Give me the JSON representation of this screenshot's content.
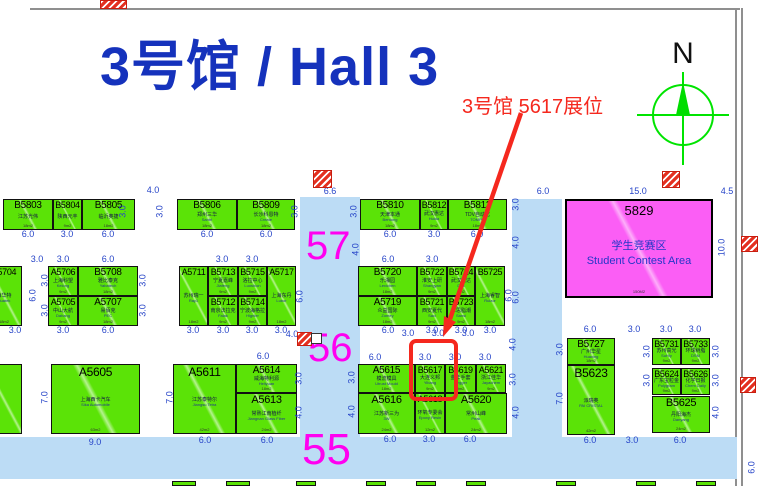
{
  "title": {
    "text": "3号馆 / Hall 3",
    "color": "#1532BC"
  },
  "annotation": {
    "text": "3号馆 5617展位",
    "color": "#F5281E",
    "target_booth": "B5617"
  },
  "compass": {
    "label": "N",
    "color": "#00E400"
  },
  "aisles": {
    "a57": {
      "label": "57"
    },
    "a56": {
      "label": "56"
    },
    "a55": {
      "label": "55"
    },
    "number_color": "#FF00F0"
  },
  "contest_area": {
    "number": "5829",
    "name_cn": "学生竞赛区",
    "name_en": "Student Contest Area",
    "size": "150M2",
    "fill": "#FB5EF5"
  },
  "colors": {
    "booth_green": "#5BE307",
    "aisle_blue": "#BCDCF5",
    "dim_blue": "#2644C8",
    "highlight_red": "#F5281E"
  },
  "booths": [
    {
      "n": "B5803",
      "cn": "江苏光伟",
      "en": "",
      "sz": "18m2",
      "r": [
        3,
        199,
        50,
        31
      ],
      "fs": 10
    },
    {
      "n": "B5804",
      "cn": "陕西元丰",
      "en": "",
      "sz": "9m2",
      "r": [
        53,
        199,
        29,
        31
      ],
      "fs": 9
    },
    {
      "n": "B5805",
      "cn": "临沂奥捷",
      "en": "",
      "sz": "18m2",
      "r": [
        82,
        199,
        53,
        31
      ],
      "fs": 10
    },
    {
      "n": "B5806",
      "cn": "郑州三华",
      "en": "Santri",
      "sz": "18m2",
      "r": [
        177,
        199,
        60,
        31
      ],
      "fs": 10
    },
    {
      "n": "B5809",
      "cn": "长沙科恩特",
      "en": "Create",
      "sz": "18m2",
      "r": [
        237,
        199,
        58,
        31
      ],
      "fs": 10
    },
    {
      "n": "B5810",
      "cn": "天津本通",
      "en": "Bentong",
      "sz": "18m2",
      "r": [
        360,
        199,
        60,
        31
      ],
      "fs": 10
    },
    {
      "n": "B5812",
      "cn": "武汉惠达",
      "en": "Huida",
      "sz": "9m2",
      "r": [
        420,
        199,
        28,
        31
      ],
      "fs": 9
    },
    {
      "n": "B5813",
      "cn": "TDV自动化",
      "en": "TOMPO",
      "sz": "18m2",
      "r": [
        448,
        199,
        59,
        31
      ],
      "fs": 10
    },
    {
      "n": "A5704",
      "cn": "西华特",
      "en": "Huatek",
      "sz": "18m2",
      "r": [
        -14,
        266,
        36,
        60
      ],
      "fs": 9
    },
    {
      "n": "A5706",
      "cn": "上海科望",
      "en": "Kelong",
      "sz": "9m2",
      "r": [
        48,
        266,
        30,
        30
      ],
      "fs": 9
    },
    {
      "n": "B5708",
      "cn": "雅比泰克",
      "en": "Yabatech",
      "sz": "18m2",
      "r": [
        78,
        266,
        60,
        30
      ],
      "fs": 10
    },
    {
      "n": "A5705",
      "cn": "中山大航",
      "en": "Dahang",
      "sz": "9m2",
      "r": [
        48,
        296,
        30,
        30
      ],
      "fs": 9
    },
    {
      "n": "A5707",
      "cn": "易佰克",
      "en": "PEC",
      "sz": "18m2",
      "r": [
        78,
        296,
        60,
        30
      ],
      "fs": 10
    },
    {
      "n": "A5711",
      "cn": "苏州瑞一",
      "en": "Ray1",
      "sz": "18m2",
      "r": [
        179,
        266,
        29,
        60
      ],
      "fs": 9
    },
    {
      "n": "B5713",
      "cn": "宁夏嘉峰",
      "en": "Jiafeng",
      "sz": "9m2",
      "r": [
        208,
        266,
        30,
        30
      ],
      "fs": 9
    },
    {
      "n": "B5715",
      "cn": "洛拉中心",
      "en": "Luoshion",
      "sz": "9m2",
      "r": [
        238,
        266,
        29,
        30
      ],
      "fs": 9
    },
    {
      "n": "A5717",
      "cn": "上海东丹",
      "en": "Lubor",
      "sz": "18m2",
      "r": [
        267,
        266,
        29,
        60
      ],
      "fs": 9
    },
    {
      "n": "B5712",
      "cn": "南京法拉克",
      "en": "Falak",
      "sz": "9m2",
      "r": [
        208,
        296,
        30,
        30
      ],
      "fs": 9
    },
    {
      "n": "B5714",
      "cn": "宁波海格拉",
      "en": "Hignler",
      "sz": "9m2",
      "r": [
        238,
        296,
        29,
        30
      ],
      "fs": 9
    },
    {
      "n": "B5720",
      "cn": "乐湘园",
      "en": "Lexichen",
      "sz": "18m2",
      "r": [
        358,
        266,
        59,
        30
      ],
      "fs": 10
    },
    {
      "n": "B5722",
      "cn": "淮安上研",
      "en": "Shangyan",
      "sz": "9m2",
      "r": [
        417,
        266,
        30,
        30
      ],
      "fs": 9
    },
    {
      "n": "B5724",
      "cn": "武汉君达",
      "en": "Dita",
      "sz": "9m2",
      "r": [
        447,
        266,
        28,
        30
      ],
      "fs": 9
    },
    {
      "n": "B5725",
      "cn": "上海睿智",
      "en": "Ruizor",
      "sz": "18m2",
      "r": [
        475,
        266,
        30,
        60
      ],
      "fs": 9
    },
    {
      "n": "A5719",
      "cn": "众益国际",
      "en": "Zomey",
      "sz": "18m2",
      "r": [
        358,
        296,
        59,
        30
      ],
      "fs": 10
    },
    {
      "n": "B5721",
      "cn": "西安夏代",
      "en": "Saci",
      "sz": "9m2",
      "r": [
        417,
        296,
        30,
        30
      ],
      "fs": 9
    },
    {
      "n": "B5723",
      "cn": "三思脂潮",
      "en": "Sansi",
      "sz": "9m2",
      "r": [
        447,
        296,
        28,
        30
      ],
      "fs": 9
    },
    {
      "n": "",
      "cn": "",
      "en": "",
      "sz": "",
      "r": [
        -14,
        364,
        36,
        70
      ],
      "fs": 9
    },
    {
      "n": "A5605",
      "cn": "上海西卡汽车",
      "en": "Sika Automobile",
      "sz": "63m2",
      "r": [
        51,
        364,
        89,
        70
      ],
      "fs": 12
    },
    {
      "n": "A5611",
      "cn": "江苏泰特尔",
      "en": "Jiangsu Tetra",
      "sz": "42m2",
      "r": [
        173,
        364,
        63,
        70
      ],
      "fs": 12
    },
    {
      "n": "A5614",
      "cn": "威海特利源",
      "en": "Heliyuan",
      "sz": "18m2",
      "r": [
        236,
        364,
        61,
        29
      ],
      "fs": 10
    },
    {
      "n": "A5613",
      "cn": "常熟江南植纤",
      "en": "Jiangnan Glass Fiber",
      "sz": "24m2",
      "r": [
        236,
        393,
        61,
        41
      ],
      "fs": 11
    },
    {
      "n": "A5615",
      "cn": "模流模具",
      "en": "Utrust Mould",
      "sz": "18m2",
      "r": [
        358,
        364,
        57,
        29
      ],
      "fs": 10
    },
    {
      "n": "B5617",
      "cn": "大连义邦",
      "en": "Yibang",
      "sz": "9m2",
      "r": [
        415,
        364,
        30,
        29
      ],
      "fs": 9
    },
    {
      "n": "B5619",
      "cn": "金华手套",
      "en": "Hegger",
      "sz": "9m2",
      "r": [
        445,
        364,
        31,
        29
      ],
      "fs": 9
    },
    {
      "n": "A5621",
      "cn": "浙江佳华",
      "en": "Jayachem",
      "sz": "9m2",
      "r": [
        476,
        364,
        30,
        29
      ],
      "fs": 9
    },
    {
      "n": "A5616",
      "cn": "江苏新三为",
      "en": "3W",
      "sz": "24m2",
      "r": [
        358,
        393,
        57,
        41
      ],
      "fs": 11
    },
    {
      "n": "A5618",
      "cn": "环氧专委会",
      "en": "Epoxy Resin",
      "sz": "12m2",
      "r": [
        415,
        393,
        30,
        41
      ],
      "fs": 9
    },
    {
      "n": "A5620",
      "cn": "常州山峰",
      "en": "Peak",
      "sz": "24m2",
      "r": [
        445,
        393,
        62,
        41
      ],
      "fs": 11
    },
    {
      "n": "B5727",
      "cn": "广州华星",
      "en": "Huaxing",
      "sz": "18m2",
      "r": [
        567,
        338,
        48,
        27
      ],
      "fs": 10
    },
    {
      "n": "B5623",
      "cn": "派瑞奥",
      "en": "PAI CRISTAL",
      "sz": "42m2",
      "r": [
        567,
        365,
        48,
        70
      ],
      "fs": 12
    },
    {
      "n": "B5731",
      "cn": "苏州高光",
      "en": "SuHiy",
      "sz": "9m2",
      "r": [
        652,
        338,
        29,
        27
      ],
      "fs": 9
    },
    {
      "n": "B5733",
      "cn": "环球树脂",
      "en": "DSM",
      "sz": "9m2",
      "r": [
        681,
        338,
        29,
        27
      ],
      "fs": 9
    },
    {
      "n": "B5624",
      "cn": "广东宝粒金",
      "en": "Polygram",
      "sz": "9m2",
      "r": [
        652,
        368,
        29,
        27
      ],
      "fs": 9
    },
    {
      "n": "B5626",
      "cn": "化学日报",
      "en": "Chem Daily",
      "sz": "9m2",
      "r": [
        681,
        368,
        29,
        27
      ],
      "fs": 9
    },
    {
      "n": "B5625",
      "cn": "丹阳海杰",
      "en": "Danyang",
      "sz": "24m2",
      "r": [
        652,
        396,
        58,
        37
      ],
      "fs": 11
    }
  ],
  "dimensions": [
    [
      "6.0",
      28,
      235,
      0
    ],
    [
      "3.0",
      67,
      235,
      0
    ],
    [
      "6.0",
      108,
      235,
      0
    ],
    [
      "4.0",
      153,
      191,
      0
    ],
    [
      "6.0",
      207,
      235,
      0
    ],
    [
      "6.0",
      266,
      235,
      0
    ],
    [
      "6.6",
      330,
      192,
      0
    ],
    [
      "6.0",
      390,
      235,
      0
    ],
    [
      "3.0",
      434,
      235,
      0
    ],
    [
      "6.0",
      477,
      235,
      0
    ],
    [
      "6.0",
      543,
      192,
      0
    ],
    [
      "15.0",
      638,
      192,
      0
    ],
    [
      "4.5",
      727,
      192,
      0
    ],
    [
      "10.0",
      722,
      248,
      1
    ],
    [
      "3.0",
      123,
      212,
      1
    ],
    [
      "3.0",
      160,
      212,
      1
    ],
    [
      "3.0",
      295,
      212,
      1
    ],
    [
      "3.0",
      354,
      212,
      1
    ],
    [
      "4.0",
      356,
      250,
      1
    ],
    [
      "3.0",
      516,
      205,
      1
    ],
    [
      "4.0",
      516,
      243,
      1
    ],
    [
      "6.0",
      516,
      298,
      1
    ],
    [
      "3.0",
      37,
      260,
      0
    ],
    [
      "3.0",
      63,
      260,
      0
    ],
    [
      "6.0",
      108,
      260,
      0
    ],
    [
      "3.0",
      222,
      260,
      0
    ],
    [
      "3.0",
      252,
      260,
      0
    ],
    [
      "6.0",
      388,
      260,
      0
    ],
    [
      "3.0",
      432,
      260,
      0
    ],
    [
      "3.0",
      15,
      331,
      0
    ],
    [
      "3.0",
      63,
      331,
      0
    ],
    [
      "6.0",
      108,
      331,
      0
    ],
    [
      "3.0",
      193,
      331,
      0
    ],
    [
      "3.0",
      223,
      331,
      0
    ],
    [
      "3.0",
      252,
      331,
      0
    ],
    [
      "3.0",
      281,
      331,
      0
    ],
    [
      "4.0",
      292,
      335,
      0
    ],
    [
      "6.0",
      388,
      331,
      0
    ],
    [
      "3.0",
      432,
      331,
      0
    ],
    [
      "3.0",
      461,
      331,
      0
    ],
    [
      "3.0",
      490,
      331,
      0
    ],
    [
      "6.0",
      33,
      296,
      1
    ],
    [
      "3.0",
      45,
      281,
      1
    ],
    [
      "3.0",
      45,
      311,
      1
    ],
    [
      "3.0",
      143,
      281,
      1
    ],
    [
      "3.0",
      143,
      311,
      1
    ],
    [
      "6.0",
      300,
      297,
      1
    ],
    [
      "6.0",
      509,
      296,
      1
    ],
    [
      "6.0",
      263,
      357,
      0
    ],
    [
      "6.0",
      375,
      358,
      0
    ],
    [
      "3.0",
      425,
      358,
      0
    ],
    [
      "3.0",
      455,
      358,
      0
    ],
    [
      "3.0",
      485,
      358,
      0
    ],
    [
      "3.0",
      408,
      334,
      0
    ],
    [
      "3.0",
      438,
      334,
      0
    ],
    [
      "3.0",
      468,
      334,
      0
    ],
    [
      "4.0",
      513,
      345,
      1
    ],
    [
      "3.0",
      513,
      380,
      1
    ],
    [
      "7.0",
      45,
      398,
      1
    ],
    [
      "7.0",
      170,
      398,
      1
    ],
    [
      "3.0",
      299,
      379,
      1
    ],
    [
      "4.0",
      299,
      413,
      1
    ],
    [
      "3.0",
      352,
      378,
      1
    ],
    [
      "4.0",
      352,
      412,
      1
    ],
    [
      "9.0",
      95,
      443,
      0
    ],
    [
      "6.0",
      205,
      441,
      0
    ],
    [
      "6.0",
      267,
      441,
      0
    ],
    [
      "6.0",
      390,
      440,
      0
    ],
    [
      "3.0",
      429,
      440,
      0
    ],
    [
      "6.0",
      470,
      440,
      0
    ],
    [
      "4.0",
      516,
      413,
      1
    ],
    [
      "6.0",
      590,
      330,
      0
    ],
    [
      "3.0",
      634,
      330,
      0
    ],
    [
      "3.0",
      666,
      330,
      0
    ],
    [
      "3.0",
      695,
      330,
      0
    ],
    [
      "3.0",
      560,
      350,
      1
    ],
    [
      "7.0",
      560,
      399,
      1
    ],
    [
      "3.0",
      647,
      352,
      1
    ],
    [
      "3.0",
      647,
      381,
      1
    ],
    [
      "3.0",
      716,
      352,
      1
    ],
    [
      "3.0",
      716,
      381,
      1
    ],
    [
      "4.0",
      716,
      413,
      1
    ],
    [
      "6.0",
      590,
      441,
      0
    ],
    [
      "3.0",
      632,
      441,
      0
    ],
    [
      "6.0",
      680,
      441,
      0
    ],
    [
      "6.0",
      752,
      468,
      1
    ]
  ],
  "pillars": [
    [
      100,
      0,
      27,
      9
    ],
    [
      313,
      170,
      19,
      18
    ],
    [
      662,
      171,
      18,
      17
    ],
    [
      741,
      236,
      17,
      16
    ],
    [
      297,
      332,
      15,
      14
    ],
    [
      740,
      377,
      16,
      16
    ]
  ],
  "white_box": [
    311,
    333,
    11,
    11
  ],
  "slivers": [
    [
      172,
      24
    ],
    [
      226,
      24
    ],
    [
      296,
      20
    ],
    [
      366,
      20
    ],
    [
      416,
      20
    ],
    [
      466,
      20
    ],
    [
      556,
      20
    ],
    [
      636,
      20
    ],
    [
      696,
      20
    ]
  ]
}
